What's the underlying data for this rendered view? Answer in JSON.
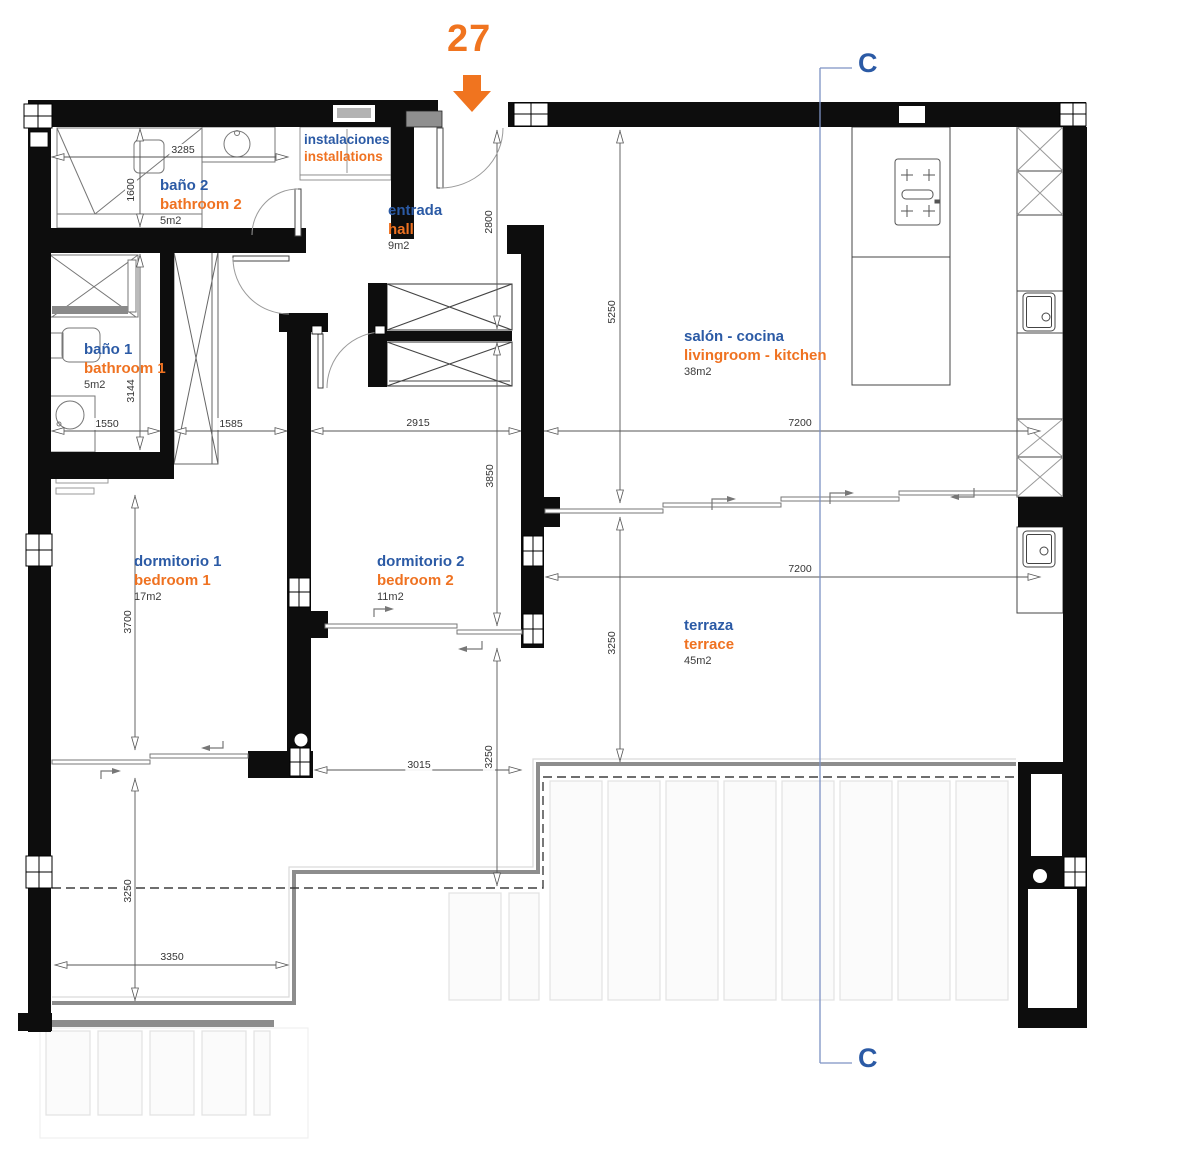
{
  "plan": {
    "unit": {
      "number": "27"
    },
    "section": {
      "label": "C"
    },
    "colors": {
      "room_es": "#2b5aa5",
      "room_en": "#ef7221",
      "area_text": "#3c3c3c",
      "dim_text": "#333333",
      "marker": "#f0741f",
      "section_text": "#2b5aa5",
      "section_line": "#7d92c4",
      "wall": "#0d0d0d"
    },
    "rooms": [
      {
        "name_es": "baño 2",
        "name_en": "bathroom 2",
        "area": "5m2"
      },
      {
        "name_es": "instalaciones",
        "name_en": "installations",
        "area": ""
      },
      {
        "name_es": "entrada",
        "name_en": "hall",
        "area": "9m2"
      },
      {
        "name_es": "salón - cocina",
        "name_en": "livingroom - kitchen",
        "area": "38m2"
      },
      {
        "name_es": "baño 1",
        "name_en": "bathroom 1",
        "area": "5m2"
      },
      {
        "name_es": "dormitorio 1",
        "name_en": "bedroom 1",
        "area": "17m2"
      },
      {
        "name_es": "dormitorio 2",
        "name_en": "bedroom 2",
        "area": "11m2"
      },
      {
        "name_es": "terraza",
        "name_en": "terrace",
        "area": "45m2"
      }
    ],
    "dimensions": [
      {
        "value": "3285"
      },
      {
        "value": "1600"
      },
      {
        "value": "2800"
      },
      {
        "value": "5250"
      },
      {
        "value": "3144"
      },
      {
        "value": "1550"
      },
      {
        "value": "1585"
      },
      {
        "value": "2915"
      },
      {
        "value": "7200"
      },
      {
        "value": "3850"
      },
      {
        "value": "3700"
      },
      {
        "value": "7200"
      },
      {
        "value": "3250"
      },
      {
        "value": "3250"
      },
      {
        "value": "3015"
      },
      {
        "value": "3250"
      },
      {
        "value": "3350"
      }
    ]
  }
}
